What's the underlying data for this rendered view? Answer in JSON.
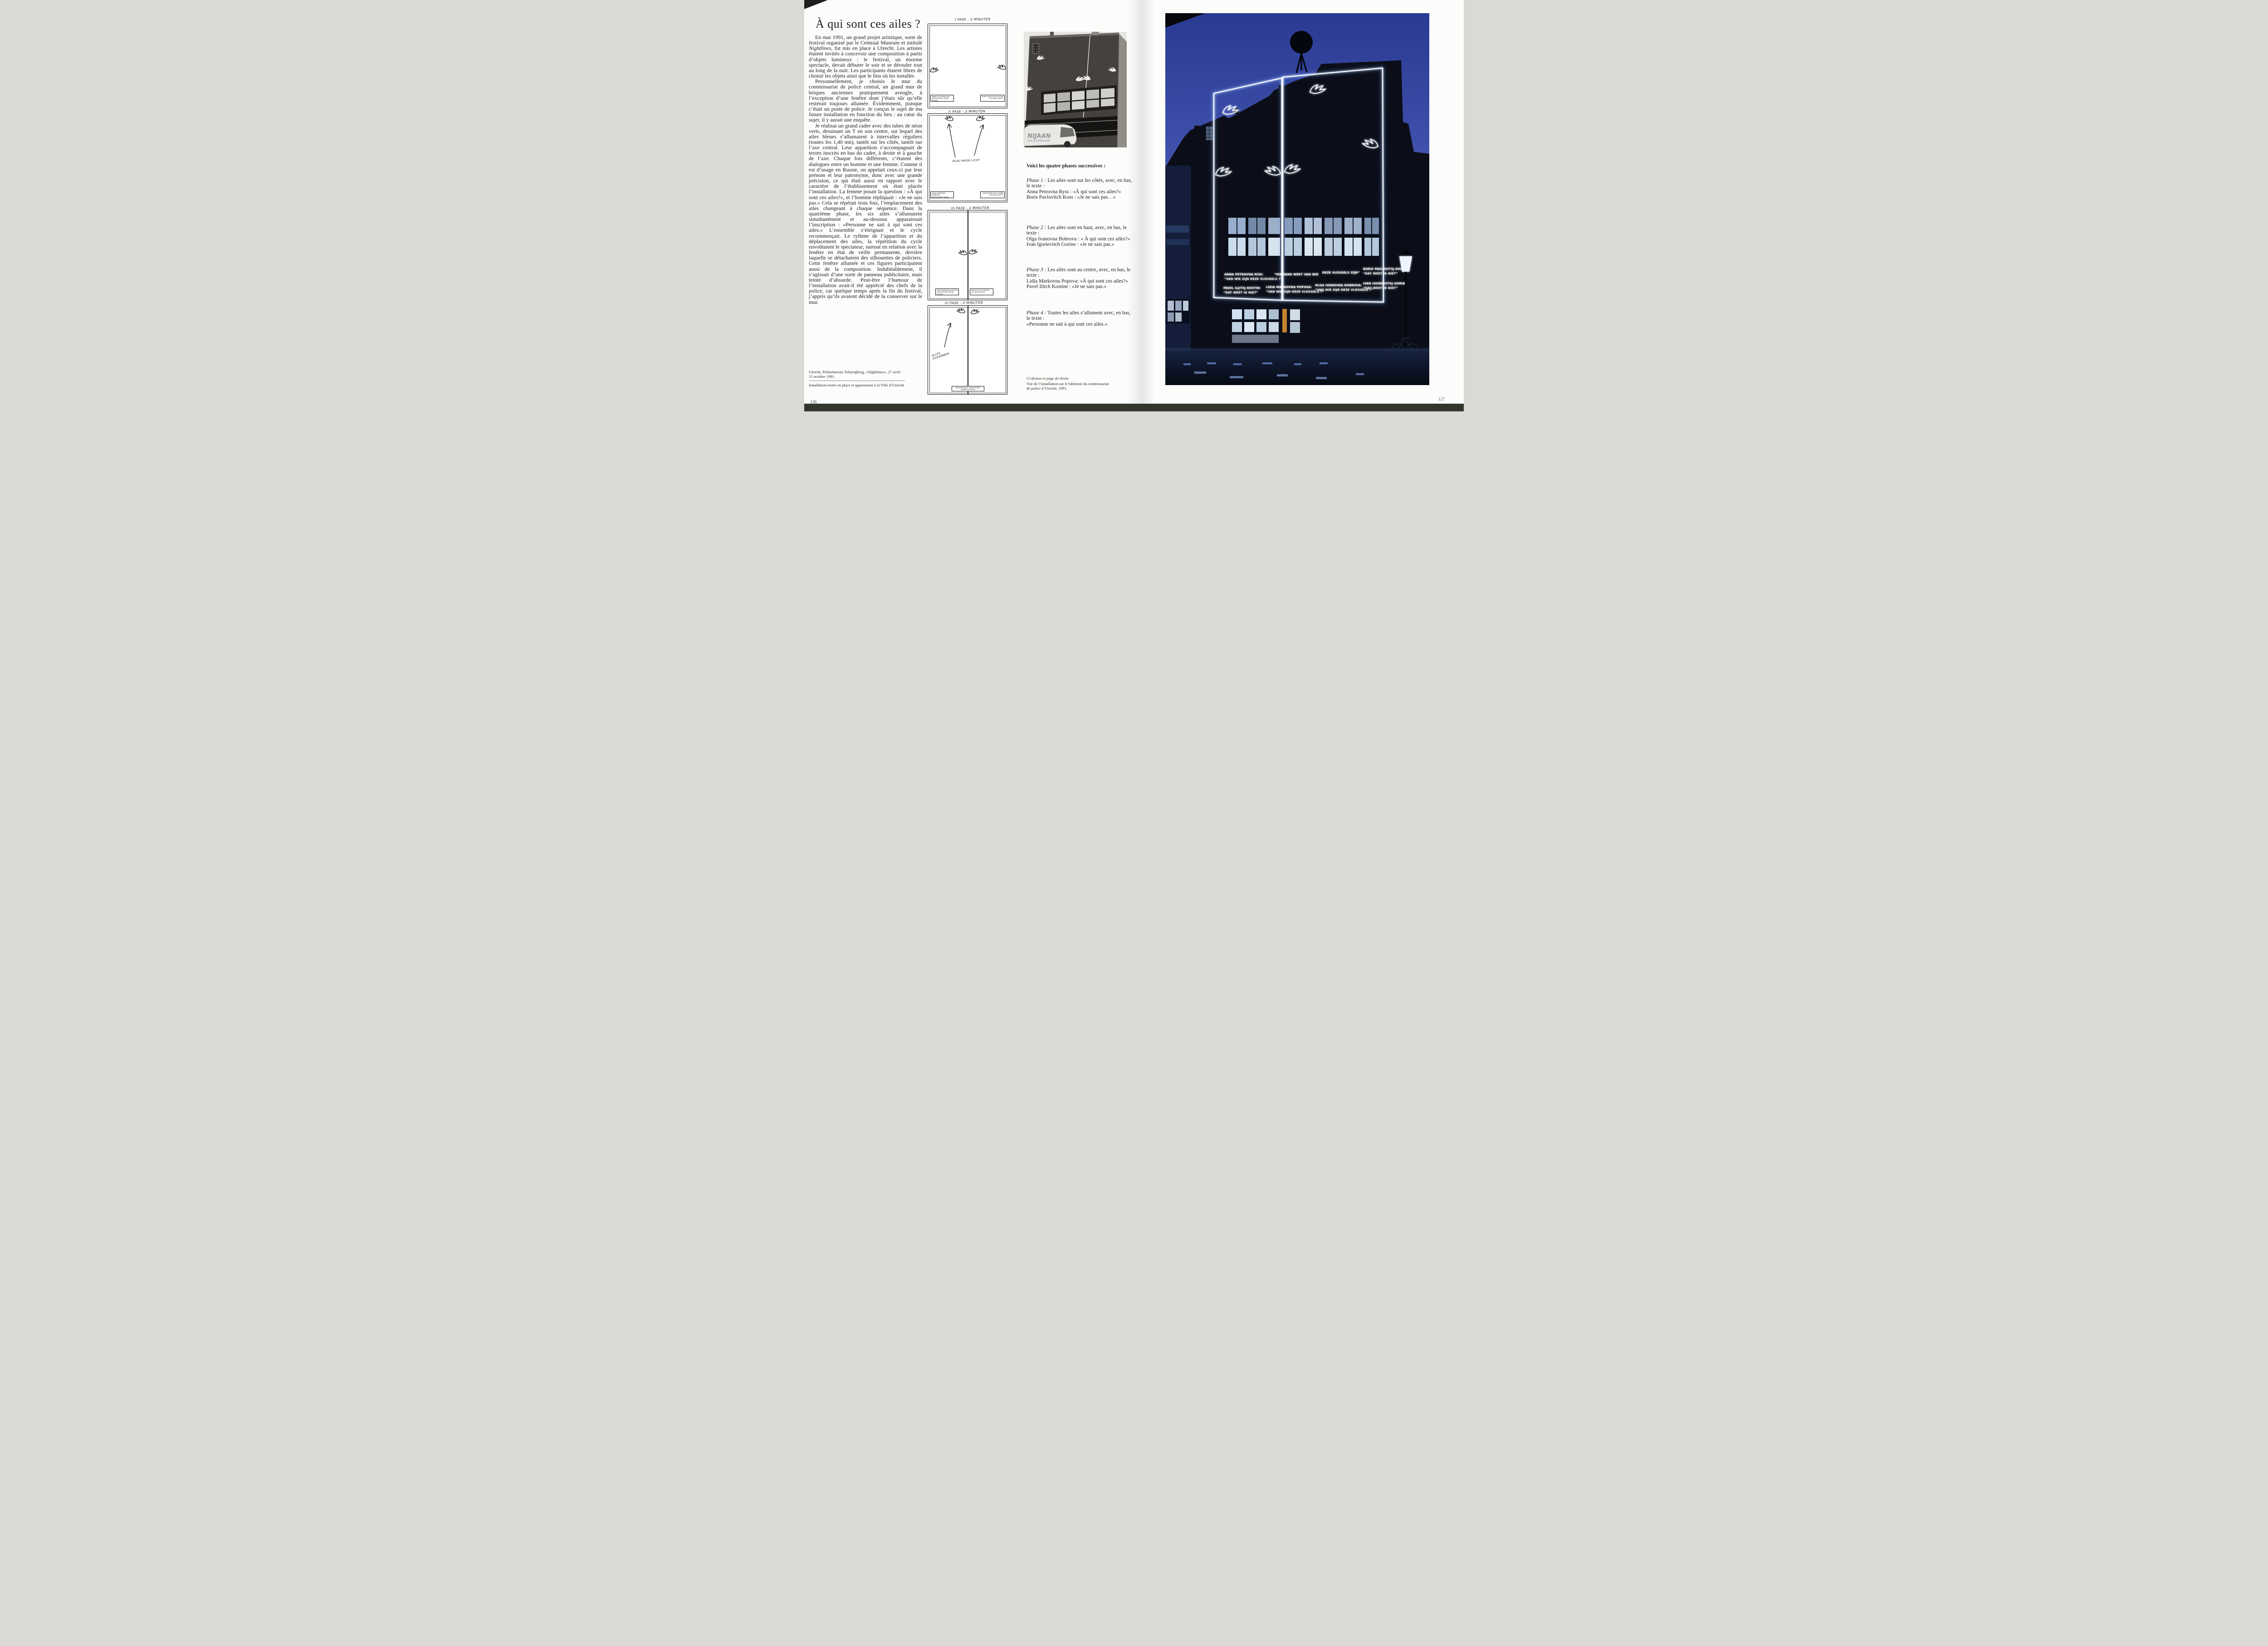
{
  "left": {
    "page_number": "126",
    "title": "À qui sont ces ailes ?",
    "article": {
      "p1a": "En mai 1991, un grand projet artistique, sorte de festival organisé par le Centraal Museum et intitulé ",
      "p1_italic": "Nightlines",
      "p1b": ", fut mis en place à Utrecht. Les artistes étaient invités à concevoir une composition à partir d’objets lumineux : le festival, un énorme spectacle, devait débuter le soir et se dérouler tout au long de la nuit. Les participants étaient libres de choisir les objets ainsi que le lieu où les installer.",
      "p2": "Personnellement, je choisis le mur du commissariat de police central, un grand mur de briques anciennes pratiquement aveugle, à l’exception d’une fenêtre dont j’étais sûr qu’elle resterait toujours allumée. Évidemment, puisque c’était un poste de police. Je conçus le sujet de ma future installation en fonction du lieu : au cœur du sujet, il y aurait une enquête.",
      "p3": "Je réalisai un grand cadre avec des tubes de néon verts, dessinant un T en son centre, sur lequel des ailes bleues s’allumaient à intervalles réguliers (toutes les 1,40 mn), tantôt sur les côtés, tantôt sur l’axe central. Leur apparition s’accompagnait de textes inscrits en bas du cadre, à droite et à gauche de l’axe. Chaque fois différents, c’étaient des dialogues entre un homme et une femme. Comme il est d’usage en Russie, on appelait ceux-ci par leur prénom et leur patronyme, donc avec une grande précision, ce qui était aussi en rapport avec le caractère de l’établissement où était placée l’installation. La femme posait la question : «À qui sont ces ailes?», et l’homme répliquait : «Je ne sais pas.» Cela se répétait trois fois, l’emplacement des ailes changeant à chaque séquence. Dans la quatrième phase, les six ailes s’allumaient simultanément et au-dessous apparaissait l’inscription : «Personne ne sait à qui sont ces ailes.» L’ensemble s’éteignait et le cycle recommençait. Le rythme de l’apparition et du déplacement des ailes, la répétition du cycle envoûtaient le spectateur, surtout en relation avec la fenêtre en état de veille permanente, derrière laquelle se détachaient des silhouettes de policiers. Cette fenêtre allumée et ces figures participaient aussi de la composition. Indubitablement, il s’agissait d’une sorte de panneau publicitaire, mais teinté d’absurde. Peut-être l’humour de l’installation avait-il été apprécié des chefs de la police, car quelque temps après la fin du festival, j’appris qu’ils avaient décidé de la conserver sur le mur."
    },
    "credits": [
      "Utrecht, Politiebureau Tolstergbrug, «Nightlines», 27 avril-15 octobre 1991.",
      "Installation restée en place et appartenant à la Ville d’Utrecht"
    ],
    "sketches": {
      "panels": [
        {
          "label": "I PASE - 2 MINUTEN",
          "sign_left": [
            "ANNA PETROVNA RISS",
            "WEM GEHÖRT DIESE FLÜGEL"
          ],
          "sign_right": [
            "BORIS PAVLOVITSCH KOSS",
            "ICH WEISS NICHT"
          ]
        },
        {
          "label": "II PASE - 2 MINUTEN",
          "annotation": "BLAU NEON LICHT",
          "sign_left": [
            "OLGA IVANOVNA BOBROVA",
            "WEM GEHÖRT DIESE FLÜGEL"
          ],
          "sign_right": [
            "IVAN IGORIEVITCH GORIN",
            "ICH WEISS NICHT"
          ]
        },
        {
          "label": "III PASE - 2 MINUTEN",
          "sign_left": [
            "LIDA MARKOVNA POPOVA",
            "WEM GEHÖRT DIESE FLÜGEL"
          ],
          "sign_right": [
            "PAVEL ILYITCH KOSTIN",
            "ICH WEISS NICHT"
          ]
        },
        {
          "label": "IV PASE - 2 MINUTEN",
          "annotation": "ALLES ZUSAMMEN",
          "sign_center": "NIEMAND WEIS, WEM GEHÖRT DIESEN FLÜGELN"
        }
      ]
    },
    "bw_photo": {
      "van_text_large": "NIJAAN",
      "van_text_small": "LEM LICHTREKLAME"
    },
    "phases": {
      "heading": "Voici les quatre phases successives :",
      "items": [
        {
          "label": "Phase 1 :",
          "intro": "Les ailes sont sur les côtés, avec, en bas, le texte :",
          "lines": [
            "Anna Petrovna Ryss : «À qui sont ces ailes?»",
            "Boris Pavlovitch Koss : «Je ne sais pas…»"
          ]
        },
        {
          "label": "Phase 2 :",
          "intro": "Les ailes sont en haut, avec, en bas, le texte :",
          "lines": [
            "Olga Ivanovna Bobrova : « À qui sont ces ailes?»",
            "Ivan Igorievitch Gorine : «Je ne sais pas.»"
          ]
        },
        {
          "label": "Phase 3 :",
          "intro": "Les ailes sont au centre, avec, en bas, le texte :",
          "lines": [
            "Lidia Markovna Popova: «À qui sont ces ailes?»",
            "Pavel Ilitch Kostine : «Je ne sais pas.»"
          ]
        },
        {
          "label": "Phase 4 :",
          "intro": "Toutes les ailes s’allument avec, en bas, le texte :",
          "lines": [
            "«Personne ne sait à qui sont ces ailes.»"
          ]
        }
      ]
    },
    "caption": {
      "lead": "Ci-dessus et page de droite",
      "text": "Vue de l’installation sur le bâtiment du commissariat de police d’Utrecht, 1991."
    }
  },
  "right": {
    "page_number": "127",
    "night_photo": {
      "description": "Night view: blue sky, dark police building, white neon frame with six neon wings and glowing text signs",
      "colors": {
        "sky_top": "#2a3a92",
        "sky_bottom": "#9aa8dc",
        "neon": "#f4f9ff",
        "building": "#0b0e18"
      },
      "signs": [
        {
          "line1": "ANNA PETROVNA RISS:",
          "line2": "“VAN WIE ZIJN DEZE VLEUGELS ?”"
        },
        {
          "line1": "“NIEMAND WEET VAN WIE",
          "line2": ""
        },
        {
          "line1": "DEZE VLEUGELS ZIJN”",
          "line2": ""
        },
        {
          "line1": "BORIS PAVLOVITSJ KOSS:",
          "line2": "“DAT WEET IK NIET”"
        },
        {
          "line1": "PAVEL ILJITSJ KOSTIN:",
          "line2": "“DAT WEET IK NIET”"
        },
        {
          "line1": "LIDIA MARKOVNA POPOVA:",
          "line2": "“VAN WIE ZIJN DEZE VLEUGELS ?”"
        },
        {
          "line1": "OLGA IVANOVNA BOBROVA:",
          "line2": "“VAN WIE ZIJN DEZE VLEUGELS ?”"
        },
        {
          "line1": "IVAN IGORIEVITSJ GORIN:",
          "line2": "“DAT WEET IK NIET”"
        }
      ]
    }
  }
}
